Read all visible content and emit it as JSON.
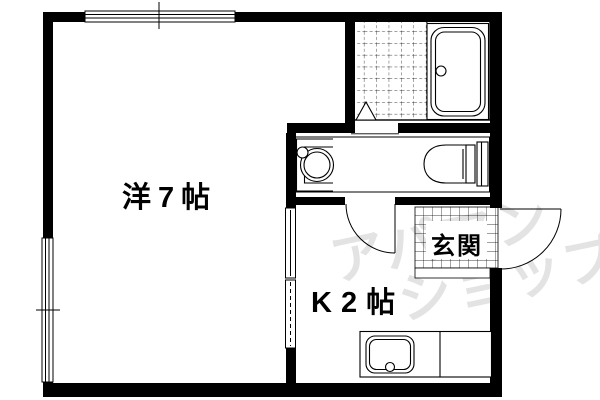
{
  "plan": {
    "rooms": [
      {
        "id": "western-room",
        "label": "洋7帖"
      },
      {
        "id": "kitchen",
        "label": "K2帖"
      },
      {
        "id": "entrance",
        "label": "玄関"
      }
    ],
    "fixtures": [
      "bathtub",
      "bath-tile-floor",
      "washbasin",
      "toilet",
      "kitchen-sink",
      "entrance-tile"
    ],
    "watermark": {
      "line1": "アパマン",
      "line2": "ショップ"
    },
    "colors": {
      "line": "#000000",
      "background": "#ffffff",
      "watermark": "#e3e3e3"
    }
  }
}
